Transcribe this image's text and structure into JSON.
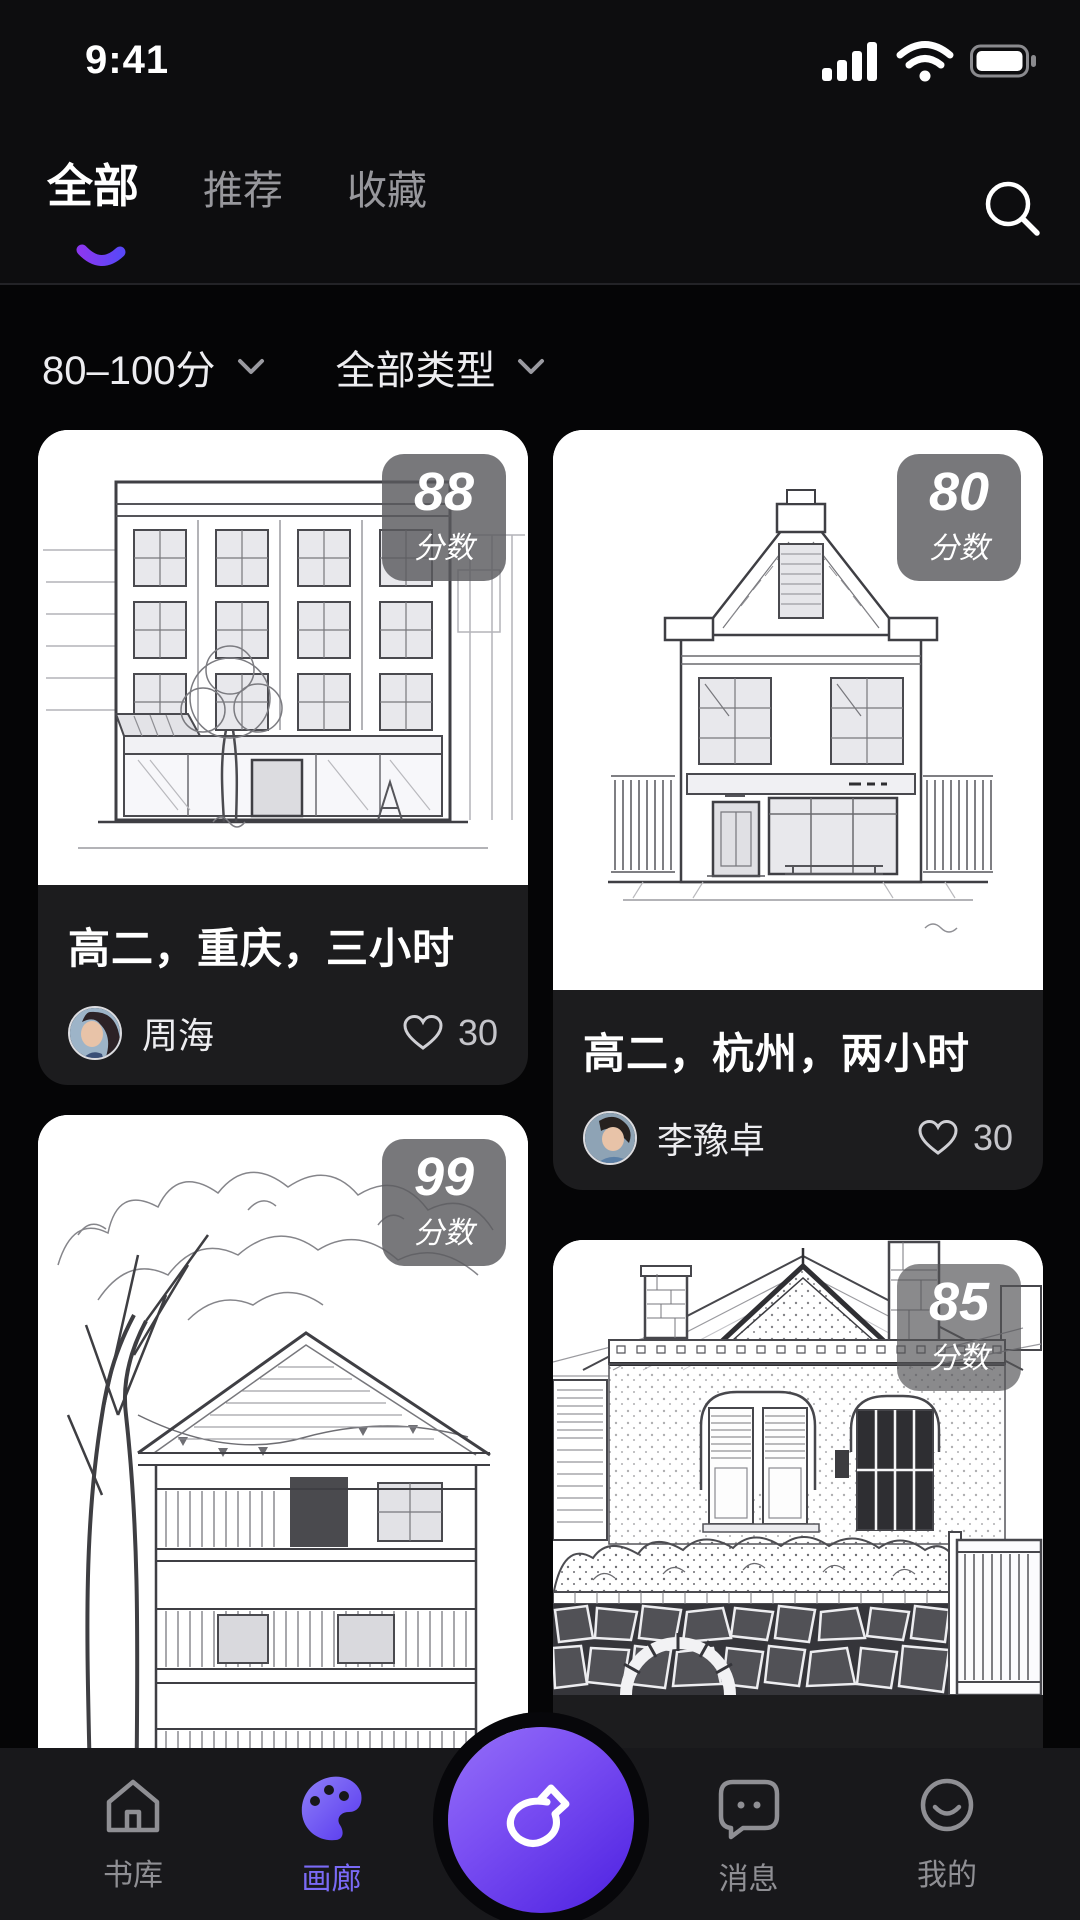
{
  "status_bar": {
    "time": "9:41"
  },
  "header": {
    "tabs": [
      {
        "label": "全部",
        "active": true
      },
      {
        "label": "推荐",
        "active": false
      },
      {
        "label": "收藏",
        "active": false
      }
    ]
  },
  "filters": {
    "score_range": "80–100分",
    "type": "全部类型"
  },
  "cards": [
    {
      "score": "88",
      "score_label": "分数",
      "title": "高二，重庆，三小时",
      "author": "周海",
      "likes": "30"
    },
    {
      "score": "80",
      "score_label": "分数",
      "title": "高二，杭州，两小时",
      "author": "李豫卓",
      "likes": "30"
    },
    {
      "score": "99",
      "score_label": "分数"
    },
    {
      "score": "85",
      "score_label": "分数"
    }
  ],
  "nav": {
    "items": [
      {
        "label": "书库",
        "icon": "home",
        "active": false
      },
      {
        "label": "画廊",
        "icon": "palette",
        "active": true
      },
      {
        "label": "消息",
        "icon": "chat-bubble",
        "active": false
      },
      {
        "label": "我的",
        "icon": "smiley",
        "active": false
      }
    ],
    "center_icon": "paint-brush"
  },
  "icons": {
    "status": [
      "signal",
      "wifi",
      "battery"
    ],
    "search": "magnifier",
    "like": "heart-outline",
    "filter_caret": "chevron-down"
  },
  "colors": {
    "page_bg": "#050506",
    "header_bg": "#0d0d0f",
    "card_footer_bg": "#1c1c1e",
    "badge_bg": "rgba(90,90,94,0.82)",
    "accent_gradient_start": "#8a3bf0",
    "accent_gradient_end": "#5a47f7",
    "nav_active": "#7a6af6",
    "inactive_gray": "#8f8f94"
  }
}
